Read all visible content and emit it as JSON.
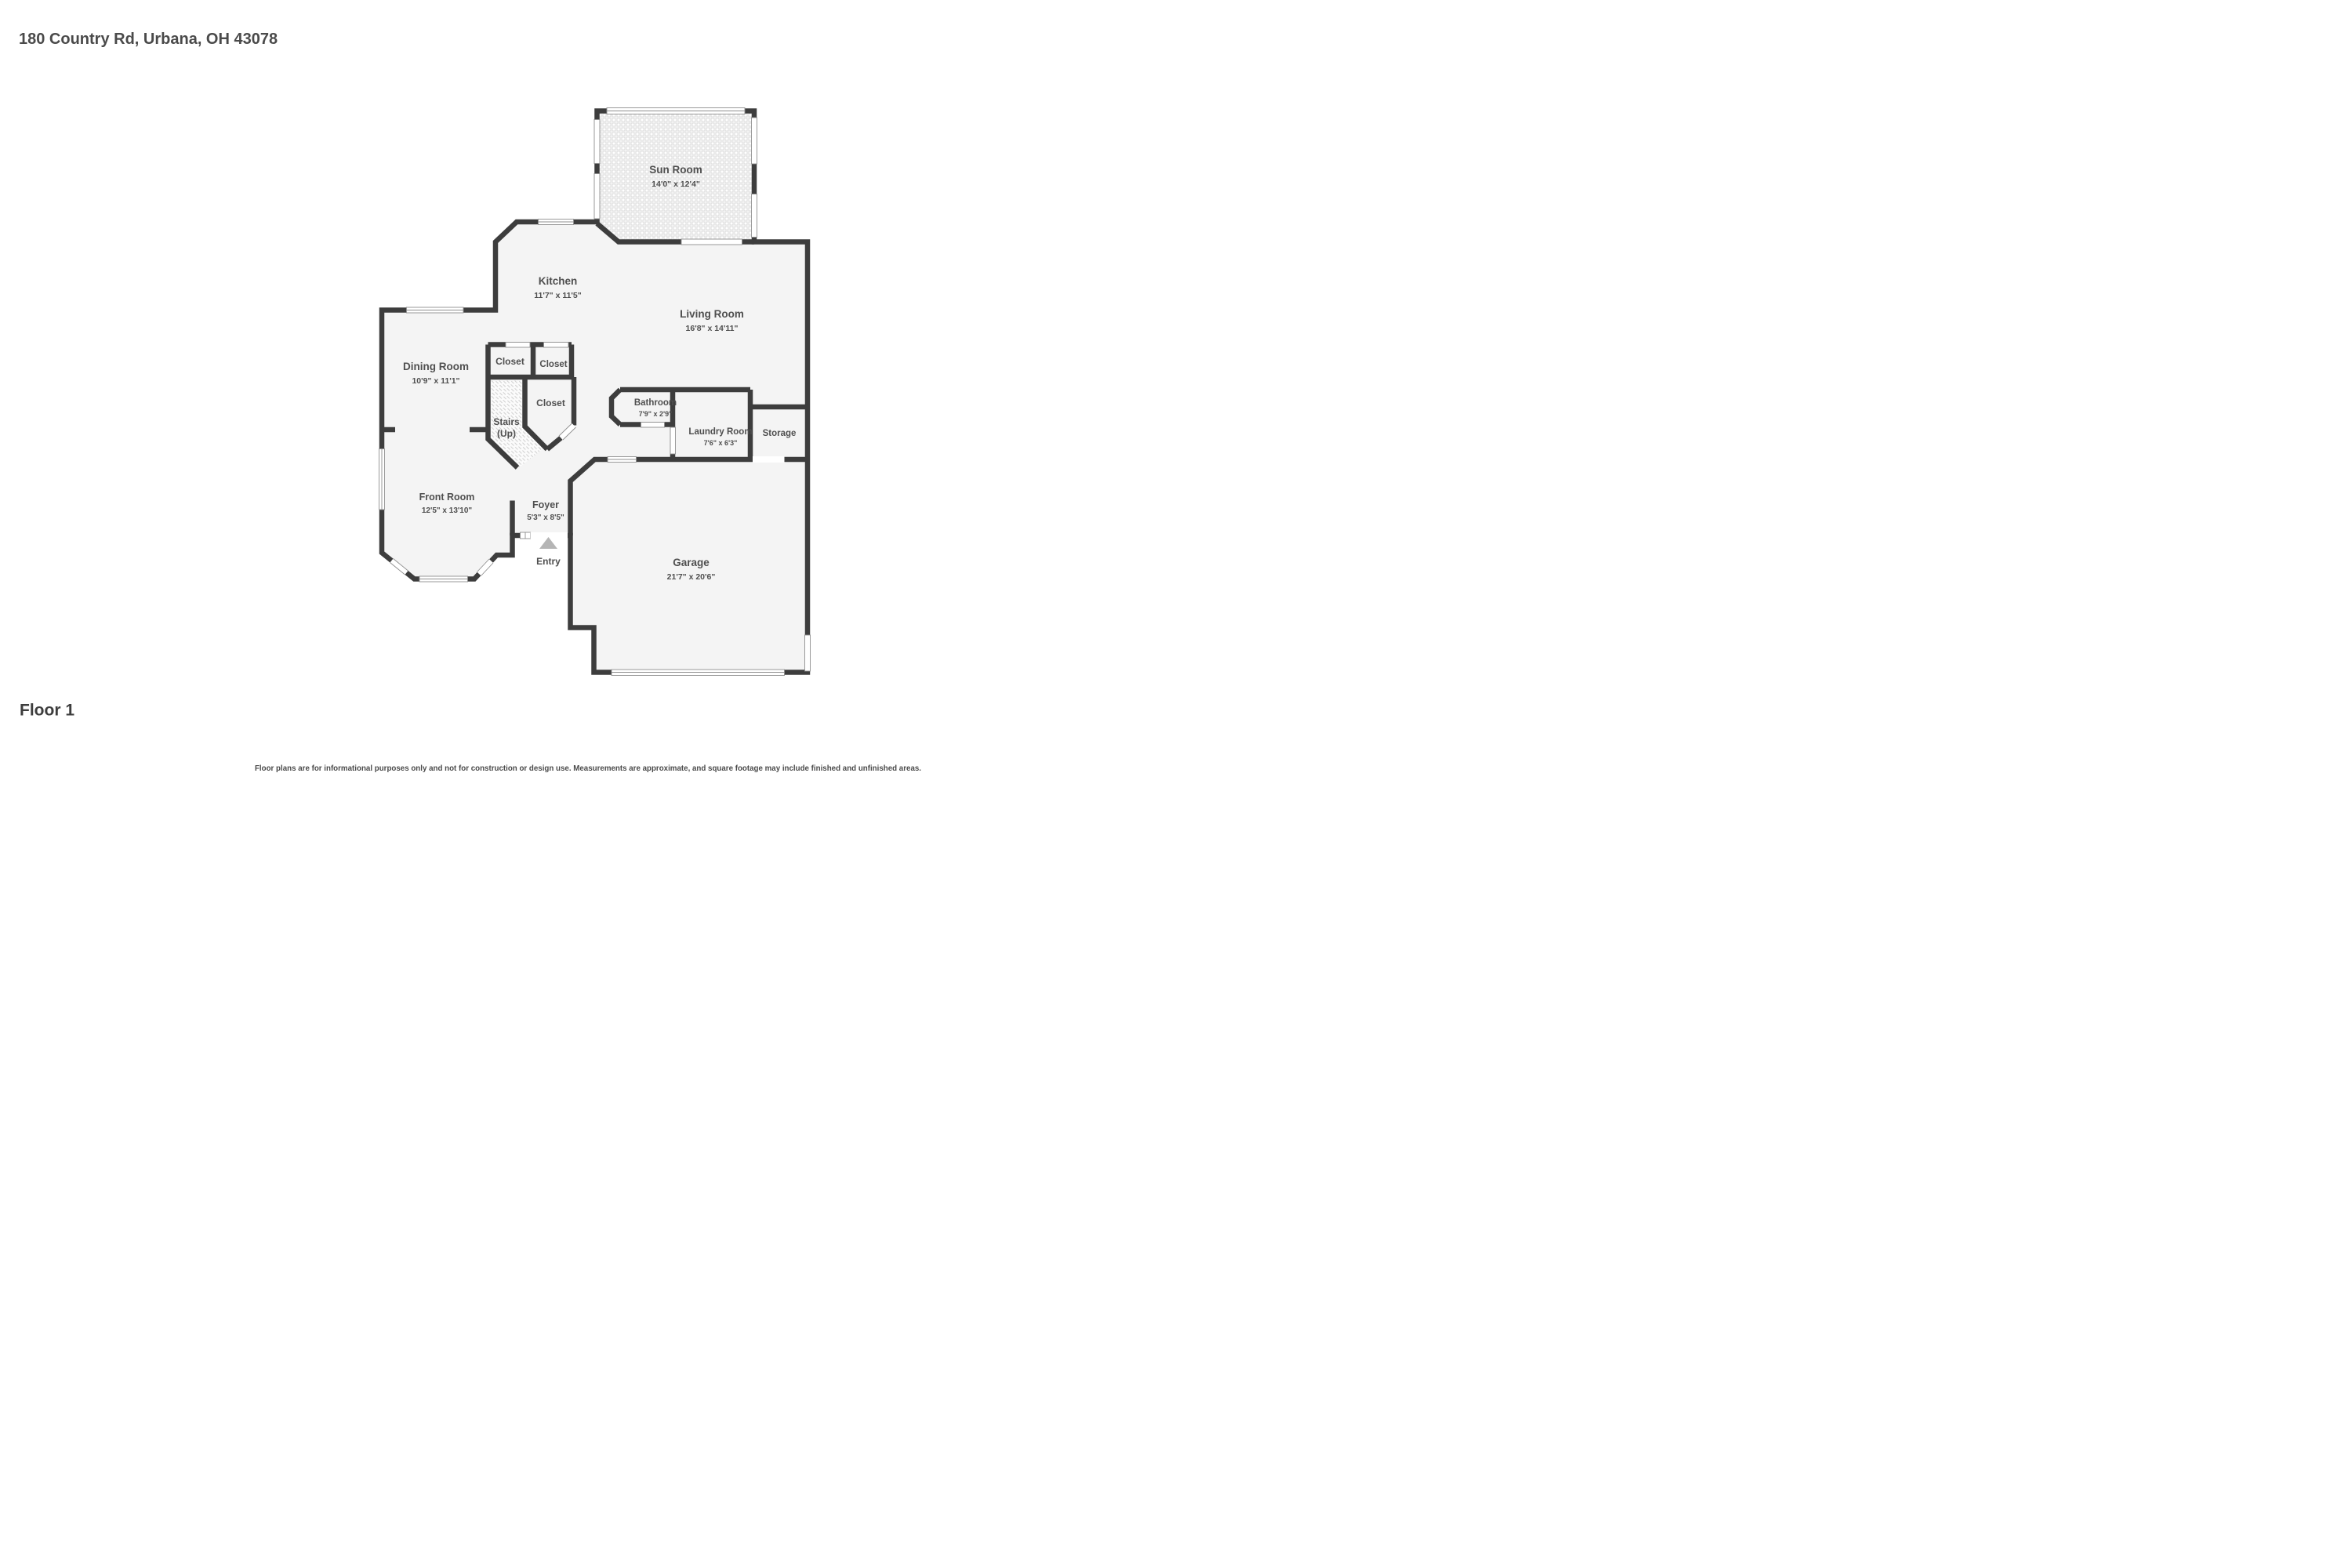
{
  "header": {
    "address": "180 Country Rd, Urbana, OH 43078"
  },
  "floor": {
    "label": "Floor 1"
  },
  "disclaimer": "Floor plans are for informational purposes only and not for construction or design use. Measurements are approximate, and square footage may include finished and unfinished areas.",
  "entry": {
    "label": "Entry"
  },
  "rooms": [
    {
      "id": "sun-room",
      "name": "Sun Room",
      "dims": "14'0\" x 12'4\""
    },
    {
      "id": "kitchen",
      "name": "Kitchen",
      "dims": "11'7\" x 11'5\""
    },
    {
      "id": "living-room",
      "name": "Living Room",
      "dims": "16'8\" x 14'11\""
    },
    {
      "id": "dining-room",
      "name": "Dining Room",
      "dims": "10'9\" x 11'1\""
    },
    {
      "id": "closet-top-left",
      "name": "Closet",
      "dims": ""
    },
    {
      "id": "closet-top-right",
      "name": "Closet",
      "dims": ""
    },
    {
      "id": "closet-lower",
      "name": "Closet",
      "dims": ""
    },
    {
      "id": "stairs",
      "name": "Stairs",
      "dims": "(Up)"
    },
    {
      "id": "bathroom",
      "name": "Bathroom",
      "dims": "7'9\" x 2'9\""
    },
    {
      "id": "laundry-room",
      "name": "Laundry Room",
      "dims": "7'6\" x 6'3\""
    },
    {
      "id": "storage",
      "name": "Storage",
      "dims": ""
    },
    {
      "id": "front-room",
      "name": "Front Room",
      "dims": "12'5\" x 13'10\""
    },
    {
      "id": "foyer",
      "name": "Foyer",
      "dims": "5'3\" x 8'5\""
    },
    {
      "id": "garage",
      "name": "Garage",
      "dims": "21'7\" x 20'6\""
    }
  ],
  "colors": {
    "wall": "#3d3d3d",
    "text": "#4f4f4f",
    "floor": "#f4f4f4",
    "entry_arrow": "#b5b5b5",
    "window_frame": "#8f8f8f",
    "background": "#ffffff"
  }
}
